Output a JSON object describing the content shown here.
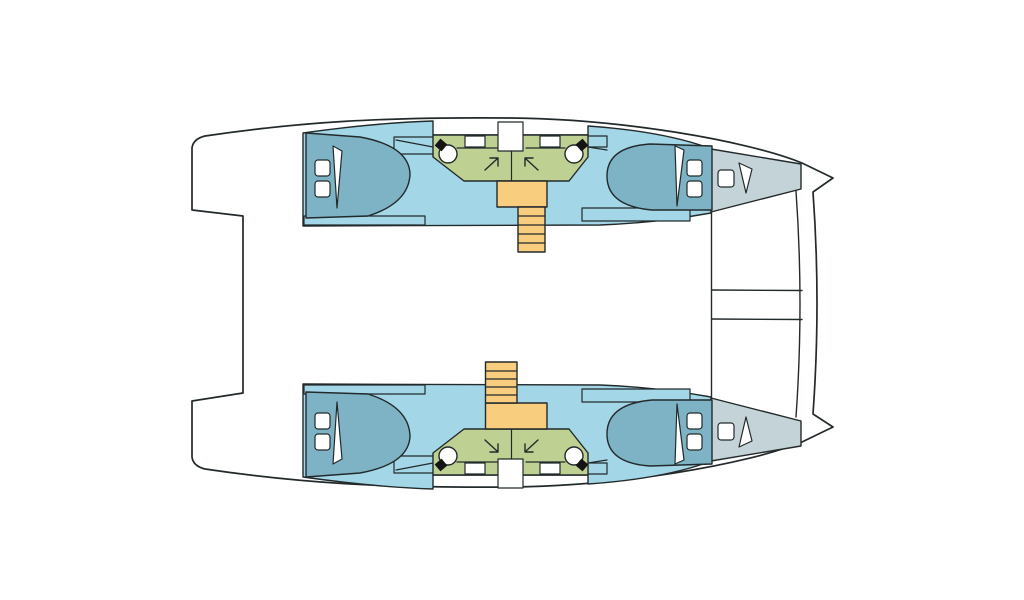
{
  "colors": {
    "background": "#ffffff",
    "deck": "#ffffff",
    "cabin_sole": "#a3d7e7",
    "berth": "#7db3c4",
    "bow_locker": "#c4d3d8",
    "wet_room": "#bed092",
    "stairs": "#f8cd7e",
    "fixture": "#ffffff",
    "faucet": "#141414",
    "outline": "#232a2c"
  },
  "layout": {
    "vessel": "catamaran deck plan, bows pointing right",
    "hulls": 2,
    "double_berths": 4,
    "bow_berths": 2,
    "wet_rooms": 2,
    "shower_compartments": 4,
    "toilets": 4,
    "sinks": 4,
    "staircases": 2,
    "transom_steps": 2
  },
  "icons": {
    "toilet": "circle with tilted black faucet square",
    "shower": "diagonal arrow in cubicle corner",
    "sink": "small outlined rectangle",
    "pillow": "rounded white square",
    "blanket": "thin white wedge on berth",
    "stairs": "ladder treads",
    "bow_hatch": "rounded white square"
  }
}
